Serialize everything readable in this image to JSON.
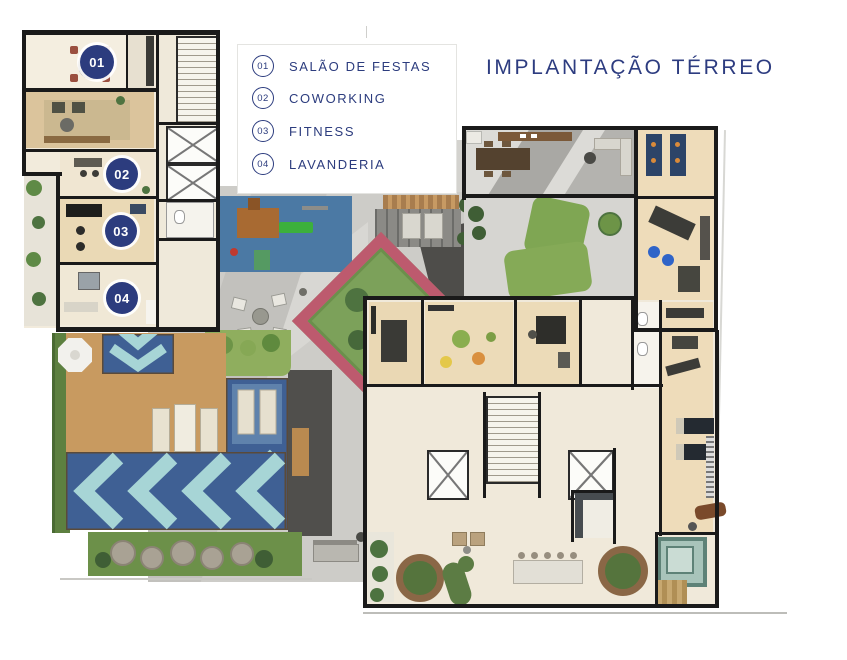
{
  "title": "IMPLANTAÇÃO TÉRREO",
  "legend": {
    "items": [
      {
        "number": "01",
        "label": "SALÃO DE FESTAS"
      },
      {
        "number": "02",
        "label": "COWORKING"
      },
      {
        "number": "03",
        "label": "FITNESS"
      },
      {
        "number": "04",
        "label": "LAVANDERIA"
      }
    ]
  },
  "plan_markers": [
    {
      "number": "01"
    },
    {
      "number": "02"
    },
    {
      "number": "03"
    },
    {
      "number": "04"
    }
  ],
  "colors": {
    "navy": "#2c3c7e",
    "pool_dark": "#3f6094",
    "pool_light": "#a7d5d6",
    "deck_wood": "#c89a60",
    "hedge_green": "#5d8040",
    "lawn_green": "#7fa653",
    "playground_blue": "#4b79a4",
    "paving_light": "#cdccc8",
    "paving_dark": "#4e4d4a",
    "floor_beige": "#f1e9d8",
    "floor_wood": "#ecdbb8",
    "wall_black": "#1a1a1a"
  }
}
